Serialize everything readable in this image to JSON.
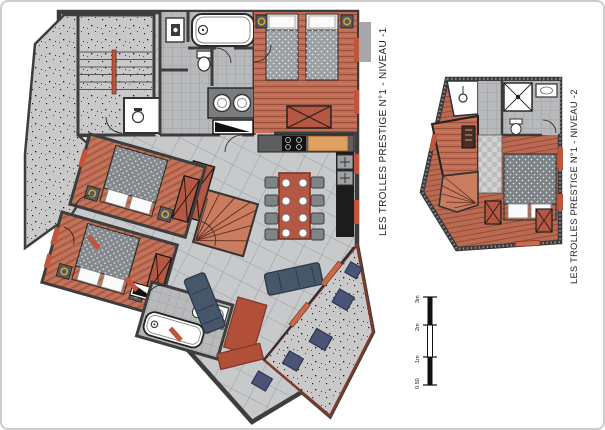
{
  "page": {
    "background": "#ffffff",
    "border_color": "#cdcdcd",
    "type": "architectural-floor-plan-sheet"
  },
  "plans": [
    {
      "id": "niveau-1",
      "title": "LES TROLLES PRESTIGE N°1 - NIVEAU -1",
      "rooms": [
        "communal-stairwell",
        "entrance-hall",
        "bathroom-1",
        "wc",
        "bedroom-1-twin-beds",
        "bedroom-2-double-bed",
        "bedroom-3-double-bed",
        "bathroom-2",
        "kitchen",
        "dining-area",
        "living-room",
        "interior-winder-staircase",
        "terrace"
      ]
    },
    {
      "id": "niveau-2",
      "title": "LES TROLLES PRESTIGE N°1 - NIVEAU -2",
      "rooms": [
        "ski-room",
        "hallway",
        "shower-room",
        "wc",
        "sauna",
        "interior-winder-staircase",
        "bedroom-double-bed",
        "wardrobes"
      ]
    }
  ],
  "scale_bar": {
    "labels": [
      "3m",
      "2m",
      "1m",
      "0.50"
    ]
  },
  "colors": {
    "wall": "#3d3d3d",
    "wood_floor": "#bf6e55",
    "tile_floor": "#c7c9cb",
    "concrete": "#c9c9c9",
    "furniture_red": "#b55843",
    "window_red": "#c0543c",
    "door_orange": "#c96a4a",
    "sofa_blue": "#46566b",
    "outdoor_blue": "#4b5377",
    "counter_wood": "#dfa05f",
    "text": "#1f1f1f"
  }
}
